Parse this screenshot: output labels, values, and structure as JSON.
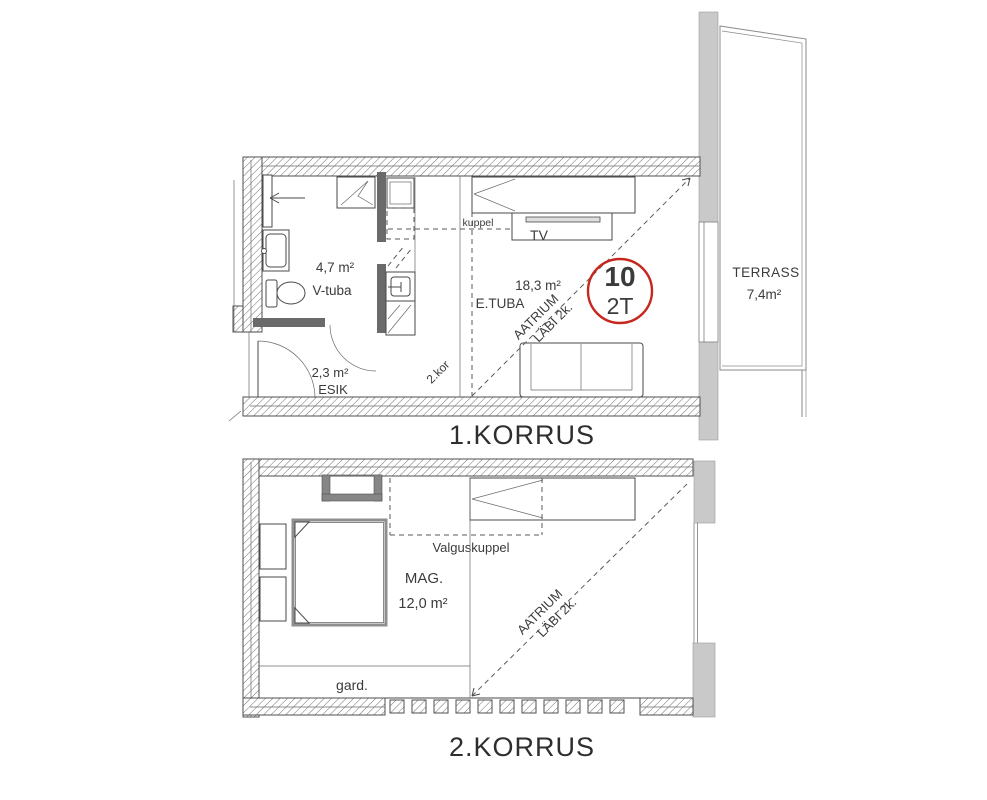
{
  "floor1": {
    "title": "1.KORRUS",
    "badge": {
      "number": "10",
      "type": "2T"
    },
    "rooms": {
      "vtuba": {
        "area": "4,7 m²",
        "name": "V-tuba"
      },
      "esik": {
        "area": "2,3 m²",
        "name": "ESIK"
      },
      "etuba": {
        "area": "18,3 m²",
        "name": "E.TUBA"
      }
    },
    "labels": {
      "kuppel": "kuppel",
      "tv": "TV",
      "second_floor_ref": "2.kor",
      "atrium_line1": "AATRIUM",
      "atrium_line2": "LÄBI 2k."
    },
    "terrace": {
      "name": "TERRASS",
      "area": "7,4m²"
    }
  },
  "floor2": {
    "title": "2.KORRUS",
    "rooms": {
      "mag": {
        "name": "MAG.",
        "area": "12,0 m²"
      }
    },
    "labels": {
      "valguskuppel": "Valguskuppel",
      "gard": "gard.",
      "atrium_line1": "AATRIUM",
      "atrium_line2": "LÄBI 2k."
    }
  },
  "colors": {
    "accent_red": "#c5271f",
    "wall_gray": "#c9c9c9",
    "dark_wall": "#6a6a6a",
    "line": "#4a4a4a"
  }
}
